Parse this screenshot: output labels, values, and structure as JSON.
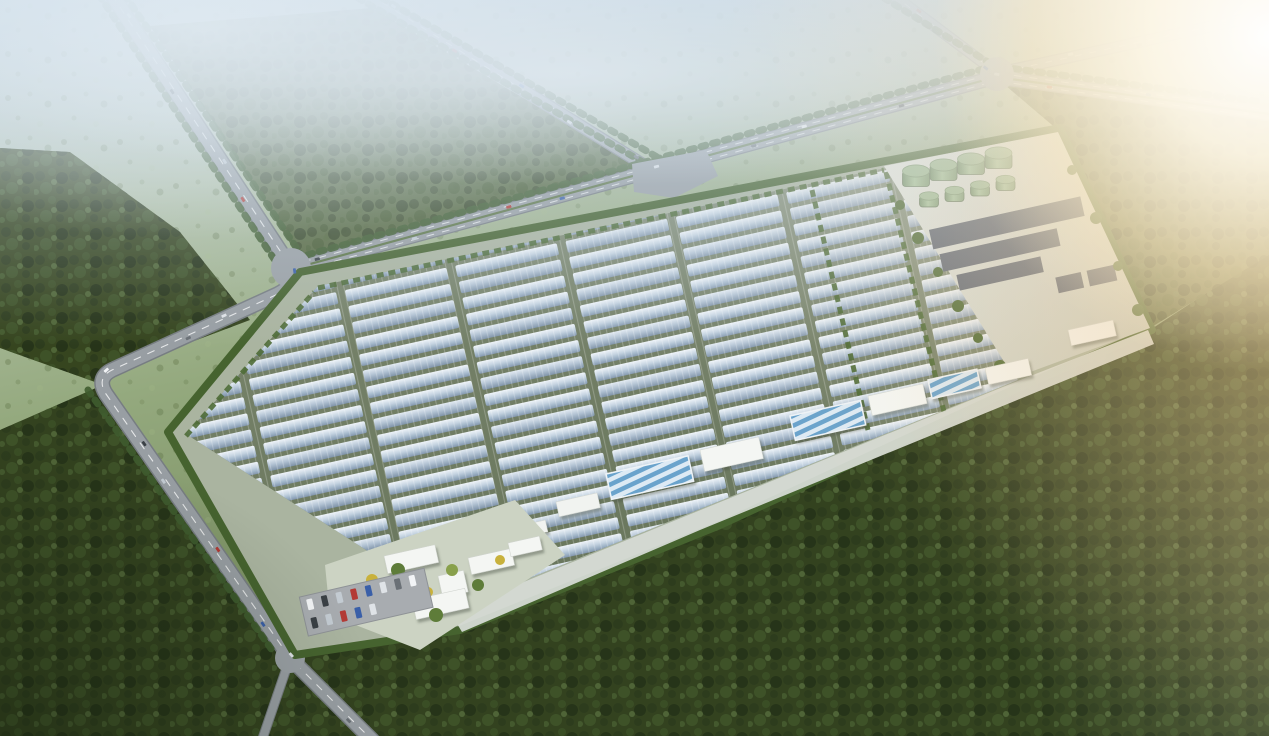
{
  "meta": {
    "title": "Aerial bird's-eye architectural rendering of a large greenhouse and solar facility",
    "render_type": "photorealistic site plan rendering",
    "text_content": "none - image contains no visible text",
    "atmosphere": "morning haze over fields at top, bright sun flare at top-right, dark forest in foreground"
  },
  "scene": {
    "facility": {
      "shape": "tilted rectangular compound with green hedge perimeter",
      "greenhouse_field": {
        "rows": 22,
        "blocks": 8,
        "row_pitch": 16.5,
        "row_height": 12,
        "block_width": 104,
        "block_pitch": 113,
        "x0": 150,
        "y0": 208,
        "row_angle_deg": -12.5,
        "appearance": "long parallel silver-blue glass greenhouse rows with white glints"
      },
      "tank_farm": {
        "large_tanks": 4,
        "small_tanks": 4,
        "color": "sage green",
        "location": "white pad at top-right corner of compound"
      },
      "panel_arrays": {
        "count": 5,
        "color": "dark slate",
        "location": "pad below tank farm"
      },
      "apron_buildings": {
        "striped_greenhouses": 3,
        "white_warehouses": 4,
        "small_sheds": 2,
        "location": "light concrete apron along the lower-right edge"
      },
      "admin_campus": {
        "white_buildings": 6,
        "landscape_trees": 9,
        "location": "lower-left corner of compound with yellow and green trees"
      },
      "parking": {
        "cars": 13
      }
    },
    "roads": {
      "count": 6,
      "features": [
        "tree-lined edges",
        "dashed lane markings",
        "gray junction pads",
        "scattered vehicles"
      ],
      "junctions": 4
    },
    "vehicles": {
      "colors": [
        "#f2f4f6",
        "#3a4045",
        "#c3cbd2",
        "#b33a35",
        "#3a5fa8",
        "#dfe3e7",
        "#6a7076"
      ],
      "roads": [
        {
          "path_id": "centerline-west",
          "cars": 14
        },
        {
          "path_id": "centerline-north",
          "cars": 12
        },
        {
          "path_id": "centerline-b",
          "cars": 5
        },
        {
          "path_id": "centerline-cd",
          "cars": 5
        }
      ],
      "parking_cars": 13
    },
    "landscape": {
      "forest_regions": 4,
      "field_color": "hazy sage green",
      "forest_color": "deep olive green",
      "sun_position": "top-right"
    }
  },
  "palette": {
    "greenhouse_light": "#eff4f9",
    "greenhouse_mid": "#c3d2e0",
    "greenhouse_dark": "#8094ab",
    "field_ground": "#6e7b5e",
    "compound_base": "#aab4a0",
    "hedge_green": "#46632f",
    "road_gray": "#989ea3",
    "road_casing": "#777d82",
    "pad_light": "#e2e5e0",
    "tank_green": "#8aa982",
    "panel_slate": "#5e6673",
    "building_white": "#f4f6f3",
    "roof_stripe_blue": "#6aa3cc",
    "forest_deep": "#2c3b1d",
    "forest_mid": "#3b4f26",
    "tree_yellow": "#c8b13c",
    "haze_blue": "#cedde9",
    "sun_warm": "#ffeec8"
  }
}
